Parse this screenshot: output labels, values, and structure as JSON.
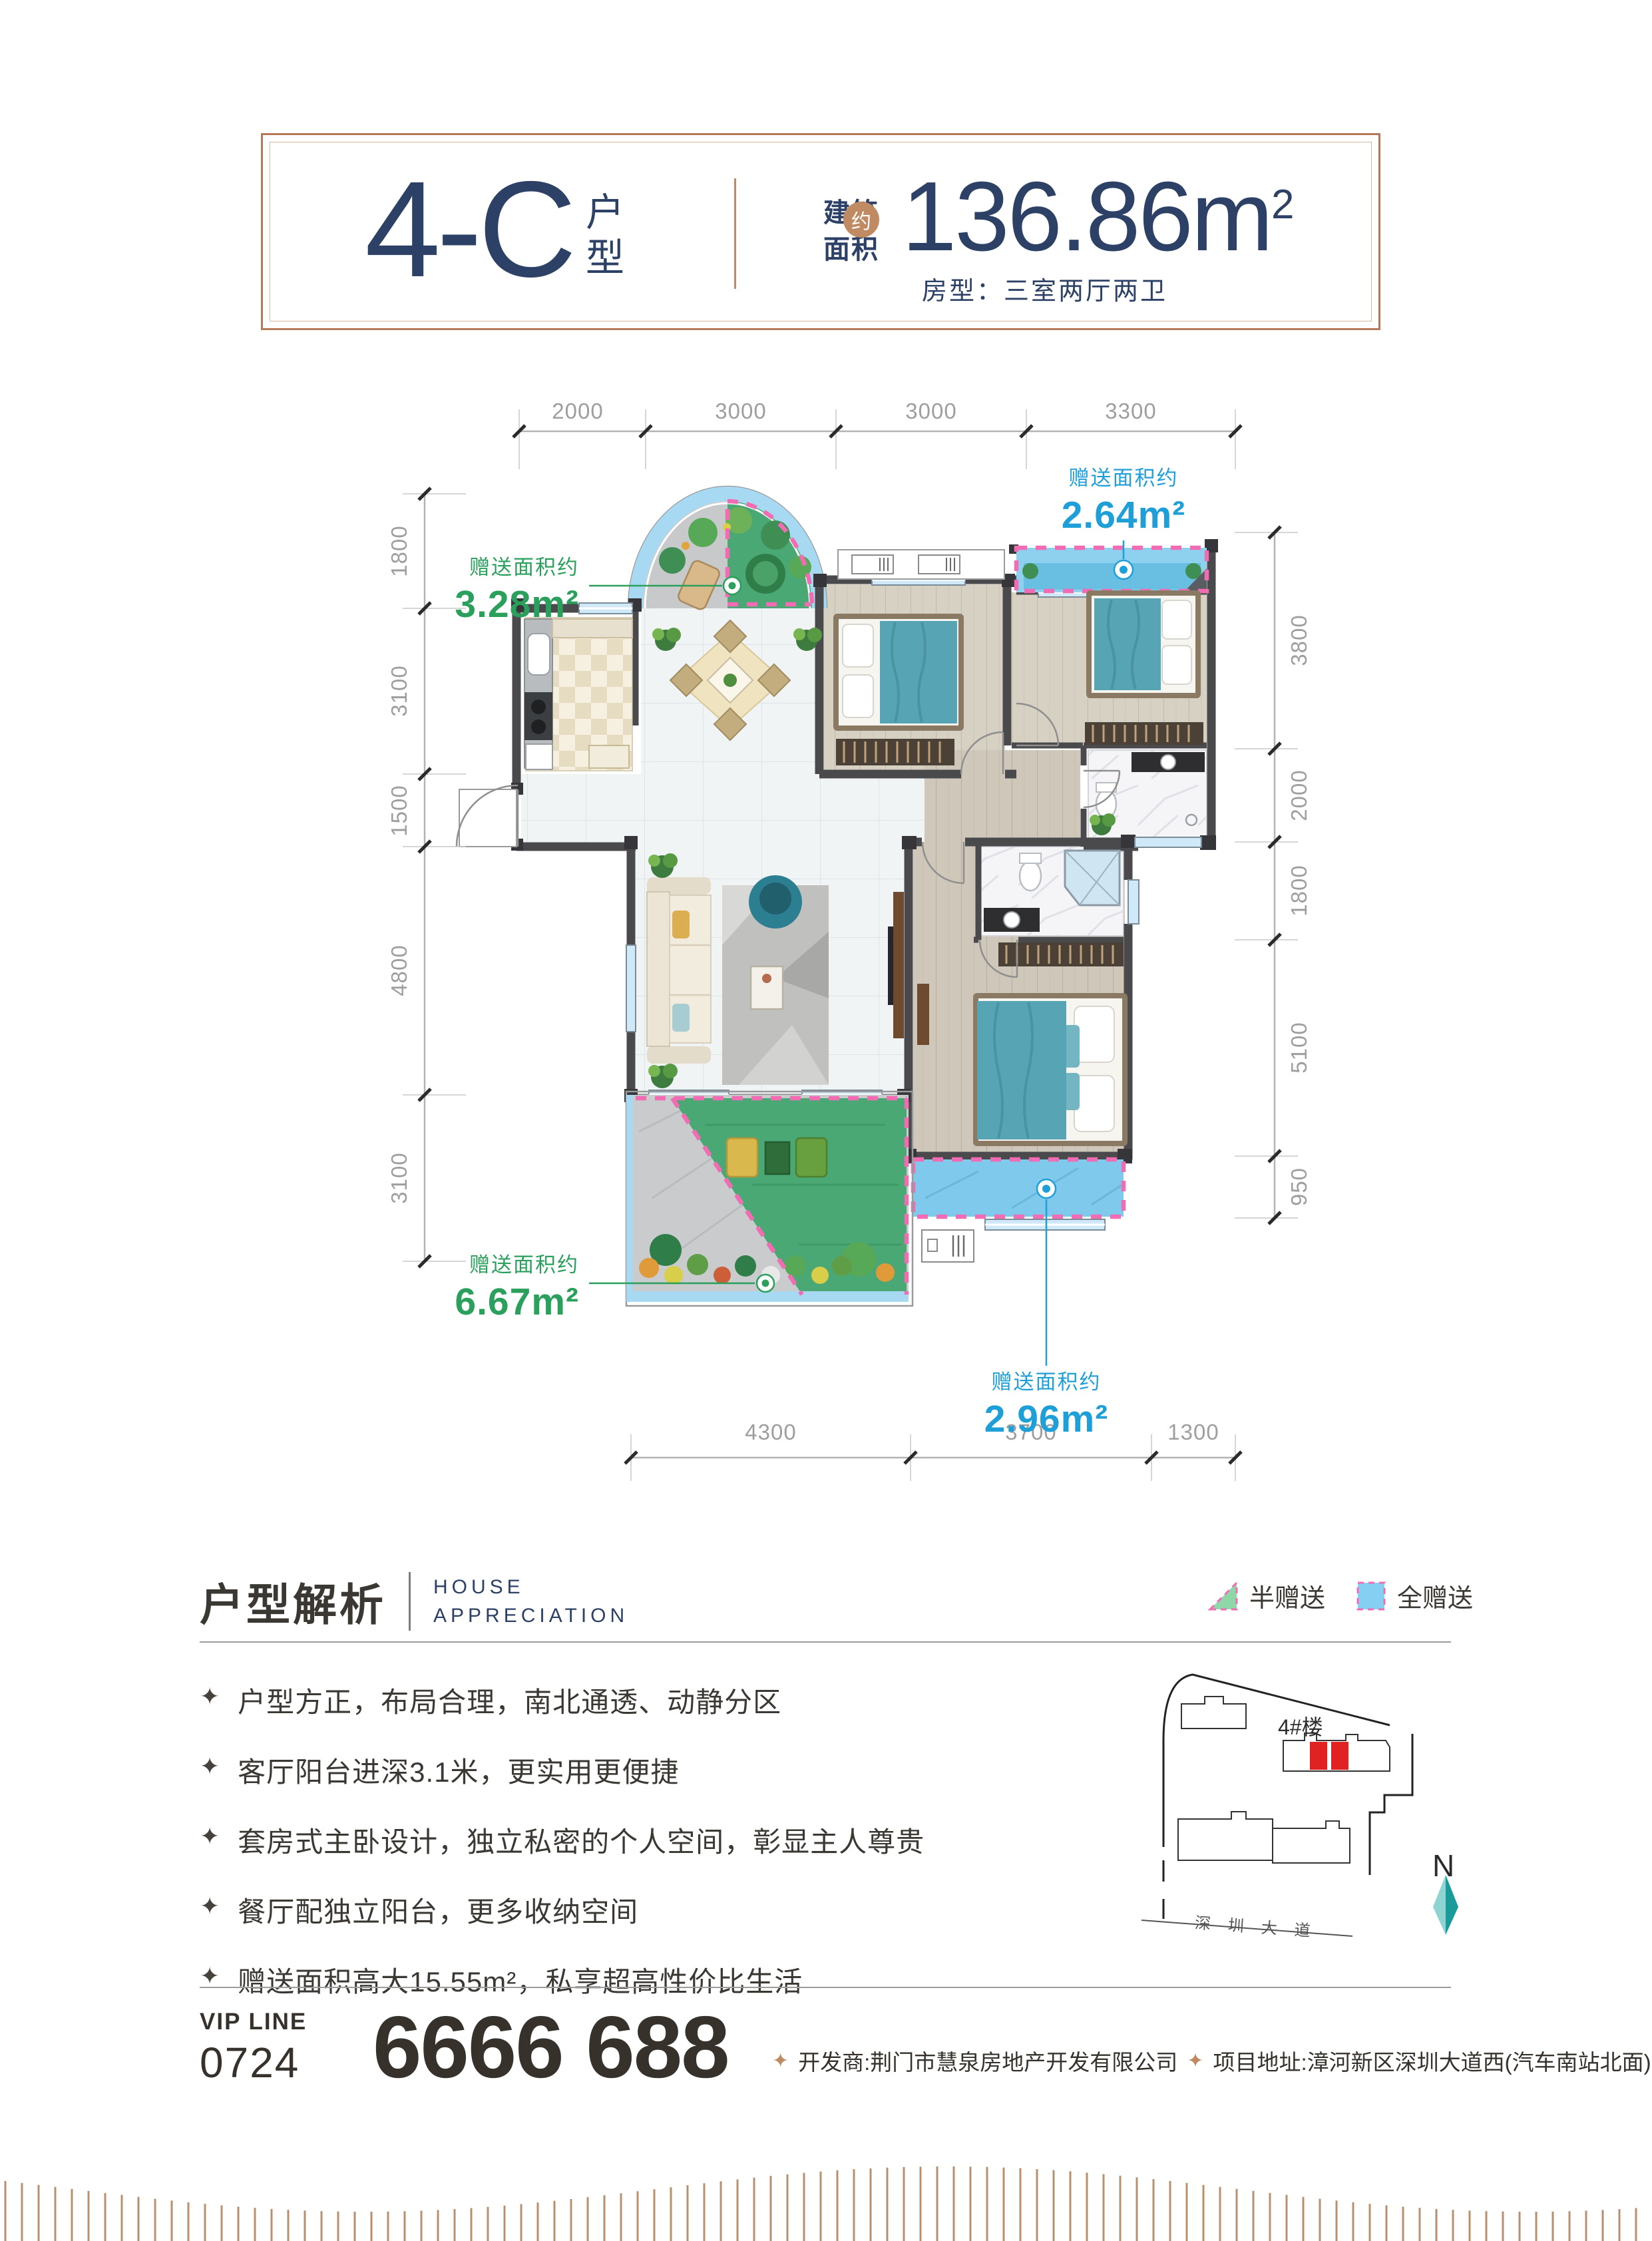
{
  "header": {
    "unit_code": "4-C",
    "unit_suffix": "户型",
    "area_label_top": "建筑",
    "area_label_bottom": "面积",
    "area_approx": "约",
    "area_value": "136.86m",
    "area_sup": "2",
    "room_type": "房型：三室两厅两卫"
  },
  "plan": {
    "dims": {
      "top": [
        "2000",
        "3000",
        "3000",
        "3300"
      ],
      "left": [
        "1800",
        "3100",
        "1500",
        "4800",
        "3100"
      ],
      "right": [
        "3800",
        "2000",
        "1800",
        "5100",
        "950"
      ],
      "bottom": [
        "4300",
        "3700",
        "1300"
      ]
    },
    "gifts": {
      "g1": {
        "label": "赠送面积约",
        "value": "3.28m²"
      },
      "g2": {
        "label": "赠送面积约",
        "value": "2.64m²"
      },
      "g3": {
        "label": "赠送面积约",
        "value": "6.67m²"
      },
      "g4": {
        "label": "赠送面积约",
        "value": "2.96m²"
      }
    }
  },
  "analysis": {
    "title": "户型解析",
    "subtitle_line1": "HOUSE",
    "subtitle_line2": "APPRECIATION",
    "bullet_icon": "✦",
    "bullets": [
      "户型方正，布局合理，南北通透、动静分区",
      "客厅阳台进深3.1米，更实用更便捷",
      "套房式主卧设计，独立私密的个人空间，彰显主人尊贵",
      "餐厅配独立阳台，更多收纳空间",
      "赠送面积高大15.55m²，私享超高性价比生活"
    ],
    "legend": {
      "half": "半赠送",
      "full": "全赠送"
    }
  },
  "sitemap": {
    "building": "4#楼",
    "road": "深圳大道",
    "north": "N"
  },
  "footer": {
    "vip_label": "VIP LINE",
    "vip_code": "0724",
    "vip_number": "6666 688",
    "diamond_icon": "✦",
    "developer": "开发商:荆门市慧泉房地产开发有限公司",
    "address": "项目地址:漳河新区深圳大道西(汽车南站北面)"
  },
  "colors": {
    "navy": "#2d4065",
    "copper": "#c08a62",
    "gift_green": "#2aa05c",
    "gift_blue": "#1f9fd8",
    "dashed_pink": "#f26cb4",
    "highlight_red": "#e02222",
    "balcony_blue": "#8ed1ef",
    "grass_green": "#49a873"
  }
}
